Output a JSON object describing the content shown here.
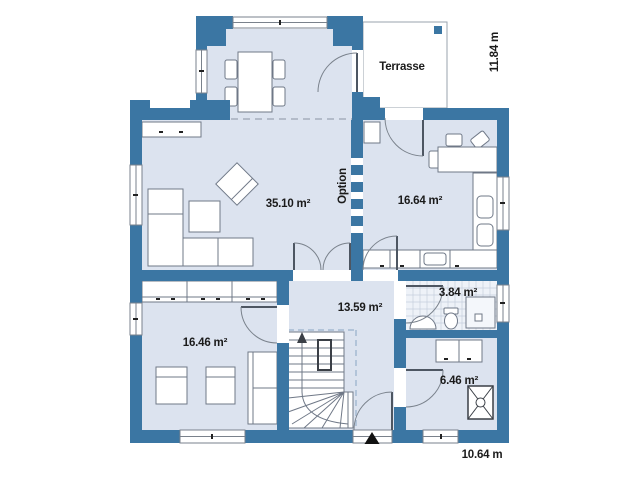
{
  "plan": {
    "rooms": [
      {
        "name": "living-room",
        "area": "35.10 m²"
      },
      {
        "name": "kitchen-dining",
        "area": "16.64 m²"
      },
      {
        "name": "hallway",
        "area": "13.59 m²"
      },
      {
        "name": "bathroom",
        "area": "3.84 m²"
      },
      {
        "name": "bedroom",
        "area": "16.46 m²"
      },
      {
        "name": "utility-room",
        "area": "6.46 m²"
      }
    ],
    "terrace_label": "Terrasse",
    "option_label": "Option",
    "dimensions": {
      "vertical": "11.84 m",
      "horizontal": "10.64 m"
    },
    "colors": {
      "wall": "#3b76a3",
      "floor": "#dce3ef",
      "terrace": "#ffffff",
      "text": "#1b1b1b"
    }
  }
}
